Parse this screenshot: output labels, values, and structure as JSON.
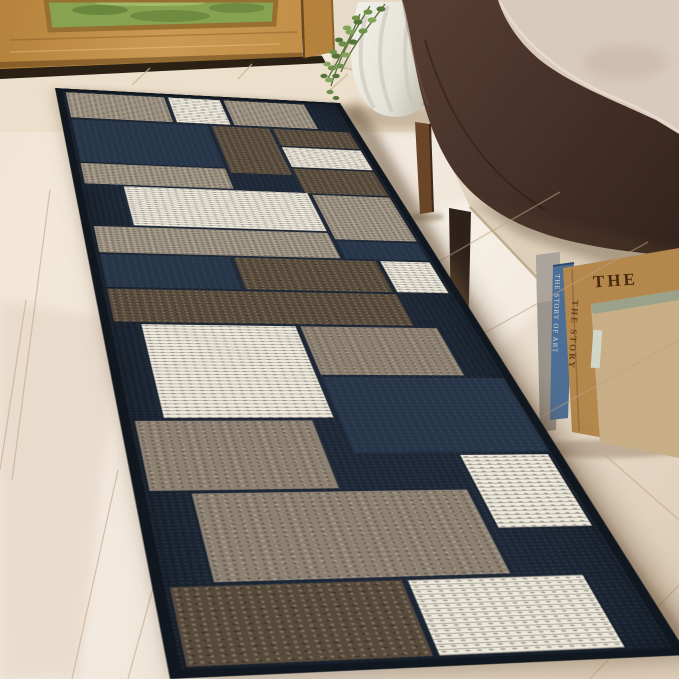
{
  "scene": {
    "description": "Product photo: modern geometric boxes runner rug in navy, grey, brown and cream, staged in an entryway with a wooden front door, dark brown fabric bench with cream pillows, silver vase with trailing green plant, and books leaning against the wall"
  },
  "books": {
    "front_title": "THE",
    "blue_spine_text": "THE STORY OF ART",
    "tan_spine_text": "THE STORY"
  },
  "palette": {
    "rug_navy": "#1c2634",
    "rug_navy_light": "#263548",
    "rug_grey": "#a29786",
    "rug_taupe": "#8d8172",
    "rug_brown": "#574a3b",
    "rug_cream": "#ece8dc",
    "bench_brown": "#452f27",
    "pillow_beige": "#d8cabc",
    "pillow_grey": "#96918a",
    "floor_light": "#f2e9de",
    "wall_beige": "#e0d3bf",
    "door_oak": "#c6934b",
    "window_green": "#87a351",
    "plant_green": "#6f9048",
    "vase_silver": "#e9e7e0",
    "book_blue": "#4d6f95",
    "book_tan": "#b4874c",
    "book_kraft": "#c7ae86"
  },
  "rug": {
    "patches": [
      {
        "x": 10,
        "y": 12,
        "w": 100,
        "h": 78,
        "c": "gray"
      },
      {
        "x": 114,
        "y": 12,
        "w": 54,
        "h": 78,
        "c": "cream"
      },
      {
        "x": 172,
        "y": 12,
        "w": 86,
        "h": 78,
        "c": "gray"
      },
      {
        "x": 10,
        "y": 96,
        "w": 134,
        "h": 118,
        "c": "navy2"
      },
      {
        "x": 148,
        "y": 96,
        "w": 58,
        "h": 132,
        "c": "brown"
      },
      {
        "x": 210,
        "y": 96,
        "w": 80,
        "h": 50,
        "c": "brown"
      },
      {
        "x": 210,
        "y": 150,
        "w": 80,
        "h": 56,
        "c": "cream"
      },
      {
        "x": 210,
        "y": 210,
        "w": 80,
        "h": 64,
        "c": "brown"
      },
      {
        "x": 10,
        "y": 218,
        "w": 134,
        "h": 52,
        "c": "gray"
      },
      {
        "x": 44,
        "y": 274,
        "w": 168,
        "h": 92,
        "c": "cream"
      },
      {
        "x": 216,
        "y": 278,
        "w": 74,
        "h": 106,
        "c": "gray"
      },
      {
        "x": 10,
        "y": 370,
        "w": 202,
        "h": 56,
        "c": "gray"
      },
      {
        "x": 216,
        "y": 388,
        "w": 74,
        "h": 38,
        "c": "navy2"
      },
      {
        "x": 10,
        "y": 430,
        "w": 106,
        "h": 64,
        "c": "navy2"
      },
      {
        "x": 120,
        "y": 430,
        "w": 122,
        "h": 64,
        "c": "brown"
      },
      {
        "x": 246,
        "y": 430,
        "w": 44,
        "h": 64,
        "c": "cream"
      },
      {
        "x": 10,
        "y": 498,
        "w": 234,
        "h": 60,
        "c": "brown"
      },
      {
        "x": 30,
        "y": 562,
        "w": 118,
        "h": 148,
        "c": "cream"
      },
      {
        "x": 152,
        "y": 562,
        "w": 110,
        "h": 82,
        "c": "taupe"
      },
      {
        "x": 152,
        "y": 648,
        "w": 140,
        "h": 112,
        "c": "navy2"
      },
      {
        "x": 10,
        "y": 714,
        "w": 122,
        "h": 92,
        "c": "taupe"
      },
      {
        "x": 226,
        "y": 764,
        "w": 64,
        "h": 94,
        "c": "cream"
      },
      {
        "x": 36,
        "y": 810,
        "w": 182,
        "h": 100,
        "c": "taupe"
      },
      {
        "x": 10,
        "y": 914,
        "w": 138,
        "h": 76,
        "c": "brown"
      },
      {
        "x": 152,
        "y": 914,
        "w": 112,
        "h": 76,
        "c": "cream"
      }
    ]
  }
}
